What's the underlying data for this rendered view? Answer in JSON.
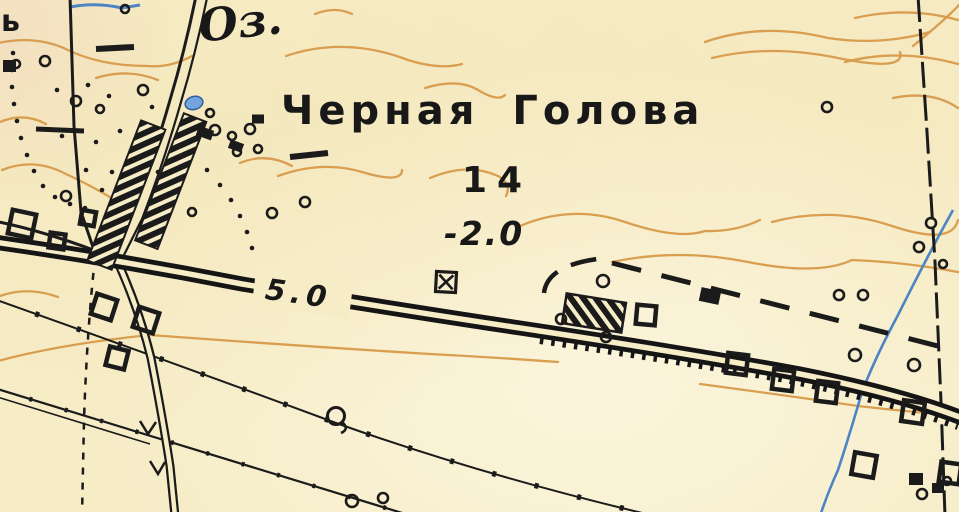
{
  "map": {
    "labels": {
      "settlement": "Черная Голова",
      "lake_abbreviation": "Оз.",
      "spot_height": "14",
      "elevation_mark": "-2.0",
      "road_width_mark": "5.0",
      "edge_letter": "ь"
    },
    "colors": {
      "paper": "#f6ecc6",
      "ink": "#1b1b1b",
      "contour_orange": "#d79a4a",
      "stream_blue": "#4d84c4",
      "lake_blue": "#74a5de"
    }
  }
}
